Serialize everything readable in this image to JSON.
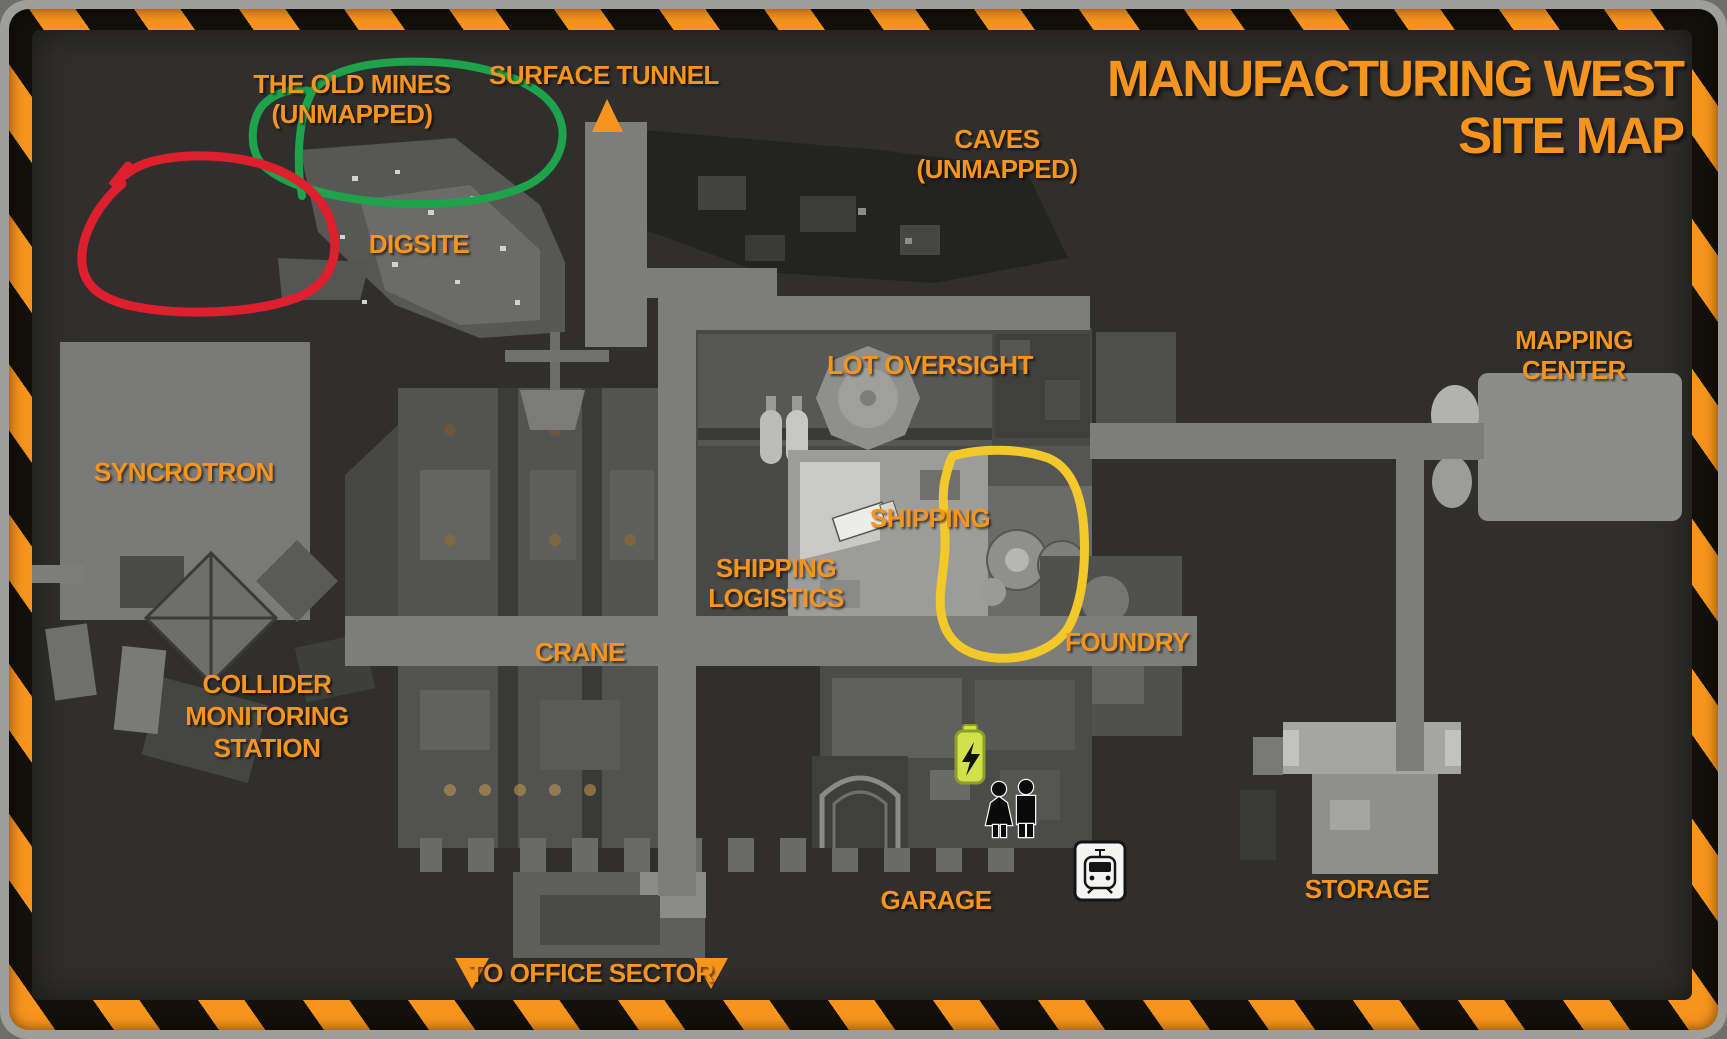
{
  "title": {
    "line1": "MANUFACTURING WEST",
    "line2": "SITE MAP"
  },
  "labels": {
    "surface_tunnel": "SURFACE TUNNEL",
    "old_mines": "THE OLD MINES\n(UNMAPPED)",
    "caves": "CAVES\n(UNMAPPED)",
    "digsite": "DIGSITE",
    "lot_oversight": "LOT OVERSIGHT",
    "shipping": "SHIPPING",
    "shipping_logistics": "SHIPPING\nLOGISTICS",
    "crane": "CRANE",
    "syncrotron": "SYNCROTRON",
    "collider_monitoring_station": "COLLIDER\nMONITORING\nSTATION",
    "foundry": "FOUNDRY",
    "mapping_center": "MAPPING CENTER",
    "garage": "GARAGE",
    "storage": "STORAGE",
    "to_office_sector": "TO OFFICE SECTOR"
  },
  "icons": {
    "battery": "battery-charging-icon",
    "woman": "woman-icon",
    "man": "man-icon",
    "train_sign": "train-station-icon",
    "up_arrow": "surface-tunnel-arrow",
    "down_arrows": "to-office-sector-arrows"
  },
  "annotations": [
    {
      "shape": "hand-drawn-circle",
      "color": "#1fa24c"
    },
    {
      "shape": "hand-drawn-circle",
      "color": "#de1f2e"
    },
    {
      "shape": "hand-drawn-circle",
      "color": "#f2c92b"
    }
  ],
  "colors": {
    "label_orange": "#f7941e",
    "hazard_orange": "#f7941d",
    "hazard_black": "#121008",
    "frame_gray": "#9e9e9c",
    "map_background": "#302f2d",
    "corridor_gray": "#7d7d7a",
    "battery_green": "#cfe24c"
  }
}
